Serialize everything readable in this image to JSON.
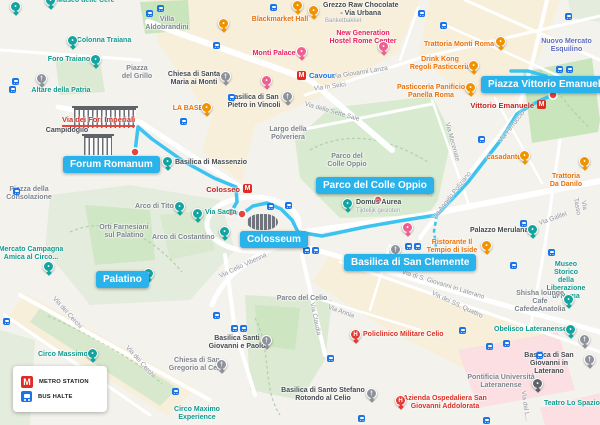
{
  "legend": {
    "items": [
      {
        "icon": "metro-icon",
        "label": "METRO STATION"
      },
      {
        "icon": "bus-icon",
        "label": "BUS HALTE"
      }
    ]
  },
  "colors": {
    "route": "#3cc3f0",
    "destination_label_bg": "#29b3ea",
    "stop_dot": "#e8453c",
    "metro": "#dd2d26",
    "bus": "#1a73e8",
    "park_bright": "#c9e5bb",
    "park_muted": "#e0eada",
    "district_cream": "#f8efdb",
    "hospital_zone": "#fbdfe2"
  },
  "street_highlight": {
    "text": "Via dei Fori Imperiali",
    "x": 62,
    "y": 115
  },
  "route": {
    "solid": [
      [
        135,
        152
      ],
      [
        138,
        127
      ],
      [
        152,
        139
      ],
      [
        183,
        161
      ],
      [
        214,
        178
      ],
      [
        236,
        187
      ],
      [
        237,
        202
      ],
      [
        231,
        212
      ],
      [
        242,
        214
      ],
      [
        253,
        206
      ],
      [
        267,
        203
      ],
      [
        281,
        209
      ],
      [
        292,
        220
      ],
      [
        298,
        232
      ],
      [
        322,
        236
      ],
      [
        365,
        227
      ],
      [
        405,
        220
      ],
      [
        437,
        215
      ],
      [
        468,
        182
      ],
      [
        500,
        141
      ],
      [
        517,
        114
      ],
      [
        528,
        107
      ],
      [
        541,
        100
      ],
      [
        553,
        95
      ],
      [
        554,
        84
      ],
      [
        546,
        76
      ],
      [
        528,
        71
      ],
      [
        511,
        71
      ]
    ],
    "dashed": [
      [
        437,
        215
      ],
      [
        434,
        231
      ],
      [
        436,
        247
      ]
    ],
    "stops": [
      [
        135,
        152
      ],
      [
        231,
        212
      ],
      [
        242,
        214
      ],
      [
        378,
        200
      ],
      [
        553,
        95
      ],
      [
        395,
        259
      ]
    ]
  },
  "destinations": [
    {
      "text": "Forum Romanum",
      "x": 63,
      "y": 156
    },
    {
      "text": "Colosseum",
      "x": 240,
      "y": 231
    },
    {
      "text": "Palatino",
      "x": 96,
      "y": 271
    },
    {
      "text": "Parco del Colle Oppio",
      "x": 316,
      "y": 177
    },
    {
      "text": "Basilica di San Clemente",
      "x": 344,
      "y": 254
    },
    {
      "text": "Piazza Vittorio Emanuele",
      "x": 481,
      "y": 76
    }
  ],
  "metro_stations": [
    {
      "name": "Cavour",
      "icon_x": 297,
      "icon_y": 71,
      "label_x": 309,
      "label_y": 71,
      "color": "#1a73e8",
      "align": "left"
    },
    {
      "name": "Colosseo",
      "icon_x": 243,
      "icon_y": 184,
      "label_x": 240,
      "label_y": 185,
      "color": "#c5221f",
      "align": "right"
    },
    {
      "name": "Vittorio Emanuele",
      "icon_x": 537,
      "icon_y": 100,
      "label_x": 534,
      "label_y": 101,
      "color": "#c5221f",
      "align": "right"
    }
  ],
  "labels": [
    {
      "l": [
        "Museo delle Cere"
      ],
      "x": 57,
      "y": -3,
      "c": "teal",
      "a": "l"
    },
    {
      "l": [
        "Colonna Traiana"
      ],
      "x": 104,
      "y": 37,
      "c": "teal"
    },
    {
      "l": [
        "Foro Traiano"
      ],
      "x": 69,
      "y": 56,
      "c": "teal"
    },
    {
      "l": [
        "Altare della Patria"
      ],
      "x": 61,
      "y": 87,
      "c": "teal"
    },
    {
      "l": [
        "Villa",
        "Aldobrandini"
      ],
      "x": 167,
      "y": 16,
      "c": "gray"
    },
    {
      "l": [
        "Campidoglio"
      ],
      "x": 67,
      "y": 127,
      "c": "dark"
    },
    {
      "l": [
        "Piazza della",
        "Consolazione"
      ],
      "x": 29,
      "y": 186,
      "c": "gray"
    },
    {
      "l": [
        "Piazza",
        "del Grillo"
      ],
      "x": 137,
      "y": 65,
      "c": "gray"
    },
    {
      "l": [
        "Chiesa di Santa",
        "Maria ai Monti"
      ],
      "x": 194,
      "y": 71,
      "c": "dark"
    },
    {
      "l": [
        "Basilica di San",
        "Pietro in Vincoli"
      ],
      "x": 254,
      "y": 94,
      "c": "dark"
    },
    {
      "l": [
        "LA BASE"
      ],
      "x": 188,
      "y": 105,
      "c": "orange"
    },
    {
      "l": [
        "Monti Palace"
      ],
      "x": 274,
      "y": 50,
      "c": "pink"
    },
    {
      "l": [
        "Blackmarket Hall"
      ],
      "x": 280,
      "y": 16,
      "c": "orange"
    },
    {
      "l": [
        "Grezzo Raw Chocolate",
        "- Via Urbana"
      ],
      "x": 323,
      "y": 2,
      "c": "dark",
      "a": "l"
    },
    {
      "l": [
        "Banketbakker"
      ],
      "x": 325,
      "y": 18,
      "c": "sub",
      "a": "l"
    },
    {
      "l": [
        "New Generation",
        "Hostel Rome Center"
      ],
      "x": 363,
      "y": 30,
      "c": "pink"
    },
    {
      "l": [
        "Trattoria Monti Roma"
      ],
      "x": 459,
      "y": 41,
      "c": "orange"
    },
    {
      "l": [
        "Nuovo Mercato Esquilino"
      ],
      "x": 533,
      "y": 38,
      "c": "purple",
      "a": "l"
    },
    {
      "l": [
        "Drink Kong",
        "Regoli Pasticceria"
      ],
      "x": 440,
      "y": 56,
      "c": "orange"
    },
    {
      "l": [
        "Pasticceria Panificio",
        "Panella Roma"
      ],
      "x": 431,
      "y": 84,
      "c": "orange"
    },
    {
      "l": [
        "Trattoria Da Danilo"
      ],
      "x": 566,
      "y": 173,
      "c": "orange"
    },
    {
      "l": [
        "casadante"
      ],
      "x": 504,
      "y": 154,
      "c": "orange"
    },
    {
      "l": [
        "Basilica di Massenzio"
      ],
      "x": 175,
      "y": 159,
      "c": "dark",
      "a": "l"
    },
    {
      "l": [
        "Largo della",
        "Polveriera"
      ],
      "x": 288,
      "y": 126,
      "c": "gray"
    },
    {
      "l": [
        "Parco del",
        "Colle Oppio"
      ],
      "x": 347,
      "y": 153,
      "c": "gray"
    },
    {
      "l": [
        "Domus Aurea"
      ],
      "x": 356,
      "y": 199,
      "c": "dark",
      "a": "l"
    },
    {
      "l": [
        "Tijdelijk gesloten"
      ],
      "x": 356,
      "y": 208,
      "c": "sub",
      "a": "l"
    },
    {
      "l": [
        "Orti Farnesiani",
        "sul Palatino"
      ],
      "x": 124,
      "y": 224,
      "c": "gray"
    },
    {
      "l": [
        "Arco di Tito"
      ],
      "x": 135,
      "y": 203,
      "c": "gray",
      "a": "l"
    },
    {
      "l": [
        "Arco di Costantino"
      ],
      "x": 152,
      "y": 234,
      "c": "gray",
      "a": "l"
    },
    {
      "l": [
        "Via Sacra"
      ],
      "x": 205,
      "y": 209,
      "c": "teal",
      "a": "l"
    },
    {
      "l": [
        "Mercato Campagna",
        "Amica al Circo..."
      ],
      "x": 31,
      "y": 246,
      "c": "teal"
    },
    {
      "l": [
        "Parco del Celio"
      ],
      "x": 302,
      "y": 295,
      "c": "gray"
    },
    {
      "l": [
        "Basilica Santi",
        "Giovanni e Paolo"
      ],
      "x": 237,
      "y": 335,
      "c": "dark"
    },
    {
      "l": [
        "Chiesa di San",
        "Gregorio al Celio"
      ],
      "x": 197,
      "y": 357,
      "c": "gray"
    },
    {
      "l": [
        "Policlinico Militare Celio"
      ],
      "x": 363,
      "y": 331,
      "c": "red",
      "a": "l"
    },
    {
      "l": [
        "Basilica di Santo Stefano",
        "Rotondo al Celio"
      ],
      "x": 323,
      "y": 387,
      "c": "dark"
    },
    {
      "l": [
        "Azienda Ospedaliera San",
        "Giovanni Addolorata"
      ],
      "x": 445,
      "y": 395,
      "c": "red"
    },
    {
      "l": [
        "Ristorante Il",
        "Tempio di Iside"
      ],
      "x": 452,
      "y": 239,
      "c": "orange"
    },
    {
      "l": [
        "Palazzo Merulana"
      ],
      "x": 470,
      "y": 227,
      "c": "dark",
      "a": "l"
    },
    {
      "l": [
        "Museo Storico della",
        "Liberazione di Roma"
      ],
      "x": 566,
      "y": 261,
      "c": "teal"
    },
    {
      "l": [
        "Shisha lounge Cafe",
        "CafedeAnatolia"
      ],
      "x": 540,
      "y": 290,
      "c": "gray"
    },
    {
      "l": [
        "Obelisco Lateranense"
      ],
      "x": 494,
      "y": 326,
      "c": "teal",
      "a": "l"
    },
    {
      "l": [
        "Basilica di San",
        "Giovanni in Laterano"
      ],
      "x": 549,
      "y": 352,
      "c": "dark"
    },
    {
      "l": [
        "Pontificia Università",
        "Lateranense"
      ],
      "x": 501,
      "y": 374,
      "c": "gray"
    },
    {
      "l": [
        "Teatro Lo Spazio"
      ],
      "x": 544,
      "y": 400,
      "c": "teal",
      "a": "l"
    },
    {
      "l": [
        "Circo Massimo"
      ],
      "x": 38,
      "y": 351,
      "c": "teal",
      "a": "l"
    },
    {
      "l": [
        "Circo Maximo",
        "Experience"
      ],
      "x": 197,
      "y": 406,
      "c": "teal"
    },
    {
      "l": [
        "Via Giovanni Lanza"
      ],
      "x": 360,
      "y": 73,
      "c": "street",
      "r": -9
    },
    {
      "l": [
        "Via in Selci"
      ],
      "x": 330,
      "y": 87,
      "c": "street",
      "r": -8
    },
    {
      "l": [
        "Via delle Sette Sale"
      ],
      "x": 332,
      "y": 112,
      "c": "street",
      "r": 16
    },
    {
      "l": [
        "Via Mecenate"
      ],
      "x": 452,
      "y": 142,
      "c": "street",
      "r": 75
    },
    {
      "l": [
        "Via Angelo Poliziano"
      ],
      "x": 452,
      "y": 196,
      "c": "street",
      "r": -52
    },
    {
      "l": [
        "Via Ferruccio"
      ],
      "x": 512,
      "y": 127,
      "c": "street",
      "r": -52
    },
    {
      "l": [
        "Via Galilei"
      ],
      "x": 553,
      "y": 219,
      "c": "street",
      "r": -20
    },
    {
      "l": [
        "Via Tasso"
      ],
      "x": 580,
      "y": 206,
      "c": "street",
      "r": 80
    },
    {
      "l": [
        "Via Celio Vibenna"
      ],
      "x": 243,
      "y": 266,
      "c": "street",
      "r": -25
    },
    {
      "l": [
        "Via dei Cerchi"
      ],
      "x": 67,
      "y": 313,
      "c": "street",
      "r": 48
    },
    {
      "l": [
        "Via dei Cerchi"
      ],
      "x": 140,
      "y": 362,
      "c": "street",
      "r": 48
    },
    {
      "l": [
        "Via di S. Giovanni in Laterano"
      ],
      "x": 443,
      "y": 285,
      "c": "street",
      "r": 17
    },
    {
      "l": [
        "Via dei SS. Quattro"
      ],
      "x": 457,
      "y": 305,
      "c": "street",
      "r": 25
    },
    {
      "l": [
        "Via Claudia"
      ],
      "x": 315,
      "y": 319,
      "c": "street",
      "r": 78
    },
    {
      "l": [
        "Via Annia"
      ],
      "x": 341,
      "y": 312,
      "c": "street",
      "r": 20
    },
    {
      "l": [
        "Via del L..."
      ],
      "x": 525,
      "y": 406,
      "c": "street",
      "r": 82
    }
  ],
  "pins": [
    {
      "t": "teal",
      "x": 15,
      "y": 7
    },
    {
      "t": "teal",
      "x": 50,
      "y": 1
    },
    {
      "t": "teal",
      "x": 72,
      "y": 41
    },
    {
      "t": "teal",
      "x": 95,
      "y": 60
    },
    {
      "t": "church",
      "x": 41,
      "y": 79
    },
    {
      "t": "church",
      "x": 225,
      "y": 77
    },
    {
      "t": "church",
      "x": 287,
      "y": 97
    },
    {
      "t": "orange",
      "x": 206,
      "y": 108
    },
    {
      "t": "orange",
      "x": 297,
      "y": 6
    },
    {
      "t": "orange",
      "x": 313,
      "y": 11
    },
    {
      "t": "orange",
      "x": 223,
      "y": 24
    },
    {
      "t": "pink",
      "x": 301,
      "y": 52
    },
    {
      "t": "pink",
      "x": 266,
      "y": 81
    },
    {
      "t": "pink",
      "x": 383,
      "y": 47
    },
    {
      "t": "orange",
      "x": 500,
      "y": 42
    },
    {
      "t": "orange",
      "x": 473,
      "y": 66
    },
    {
      "t": "orange",
      "x": 470,
      "y": 88
    },
    {
      "t": "orange",
      "x": 524,
      "y": 156
    },
    {
      "t": "orange",
      "x": 584,
      "y": 162
    },
    {
      "t": "teal",
      "x": 167,
      "y": 162
    },
    {
      "t": "teal",
      "x": 179,
      "y": 207
    },
    {
      "t": "teal",
      "x": 224,
      "y": 232
    },
    {
      "t": "teal",
      "x": 197,
      "y": 214
    },
    {
      "t": "teal",
      "x": 148,
      "y": 274
    },
    {
      "t": "teal",
      "x": 347,
      "y": 204
    },
    {
      "t": "teal",
      "x": 48,
      "y": 267
    },
    {
      "t": "teal",
      "x": 92,
      "y": 354
    },
    {
      "t": "pink",
      "x": 407,
      "y": 228
    },
    {
      "t": "church",
      "x": 395,
      "y": 250
    },
    {
      "t": "orange",
      "x": 486,
      "y": 246
    },
    {
      "t": "teal",
      "x": 532,
      "y": 230
    },
    {
      "t": "teal",
      "x": 568,
      "y": 300
    },
    {
      "t": "teal",
      "x": 570,
      "y": 330
    },
    {
      "t": "church",
      "x": 266,
      "y": 341
    },
    {
      "t": "church",
      "x": 221,
      "y": 365
    },
    {
      "t": "church",
      "x": 371,
      "y": 394
    },
    {
      "t": "church",
      "x": 589,
      "y": 360
    },
    {
      "t": "church",
      "x": 584,
      "y": 340
    },
    {
      "t": "redh",
      "x": 355,
      "y": 335
    },
    {
      "t": "redh",
      "x": 400,
      "y": 401
    },
    {
      "t": "grad",
      "x": 537,
      "y": 384
    }
  ],
  "bus_stops": [
    [
      146,
      10
    ],
    [
      157,
      5
    ],
    [
      12,
      78
    ],
    [
      9,
      86
    ],
    [
      213,
      42
    ],
    [
      270,
      4
    ],
    [
      228,
      94
    ],
    [
      180,
      118
    ],
    [
      13,
      188
    ],
    [
      267,
      203
    ],
    [
      285,
      202
    ],
    [
      303,
      247
    ],
    [
      312,
      247
    ],
    [
      405,
      243
    ],
    [
      414,
      243
    ],
    [
      478,
      136
    ],
    [
      556,
      66
    ],
    [
      566,
      66
    ],
    [
      520,
      220
    ],
    [
      548,
      249
    ],
    [
      510,
      262
    ],
    [
      3,
      318
    ],
    [
      172,
      388
    ],
    [
      95,
      397
    ],
    [
      213,
      312
    ],
    [
      231,
      325
    ],
    [
      240,
      325
    ],
    [
      327,
      355
    ],
    [
      358,
      415
    ],
    [
      503,
      340
    ],
    [
      536,
      352
    ],
    [
      459,
      327
    ],
    [
      486,
      343
    ],
    [
      483,
      417
    ],
    [
      418,
      10
    ],
    [
      440,
      22
    ],
    [
      565,
      13
    ]
  ],
  "buildings": [
    {
      "type": "temple",
      "x": 74,
      "y": 108,
      "w": 62,
      "h": 18
    },
    {
      "type": "temple",
      "x": 84,
      "y": 136,
      "w": 28,
      "h": 17
    },
    {
      "type": "arena",
      "x": 247,
      "y": 214,
      "w": 31,
      "h": 16
    }
  ]
}
